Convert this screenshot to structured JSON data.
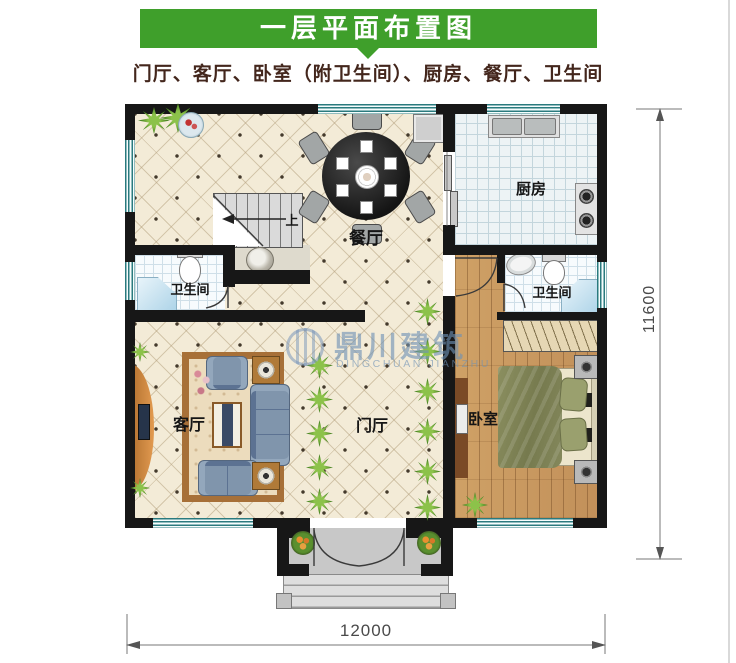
{
  "header": {
    "title": "一层平面布置图",
    "subtitle": "门厅、客厅、卧室（附卫生间）、厨房、餐厅、卫生间"
  },
  "rooms": {
    "dining": "餐厅",
    "kitchen": "厨房",
    "bath_left": "卫生间",
    "bath_right": "卫生间",
    "living": "客厅",
    "foyer": "门厅",
    "bedroom": "卧室"
  },
  "stairs": {
    "up": "上"
  },
  "watermark": {
    "brand": "鼎川建筑",
    "latin": "DINGCHUAN JIANZHU"
  },
  "dimensions": {
    "width_mm": "12000",
    "height_mm": "11600"
  },
  "colors": {
    "banner_green": "#3f9f2b",
    "wall_black": "#171717",
    "window_teal": "#2a7a7e",
    "tile_floor": "#f3ebd7",
    "wood_floor": "#c9995e"
  }
}
